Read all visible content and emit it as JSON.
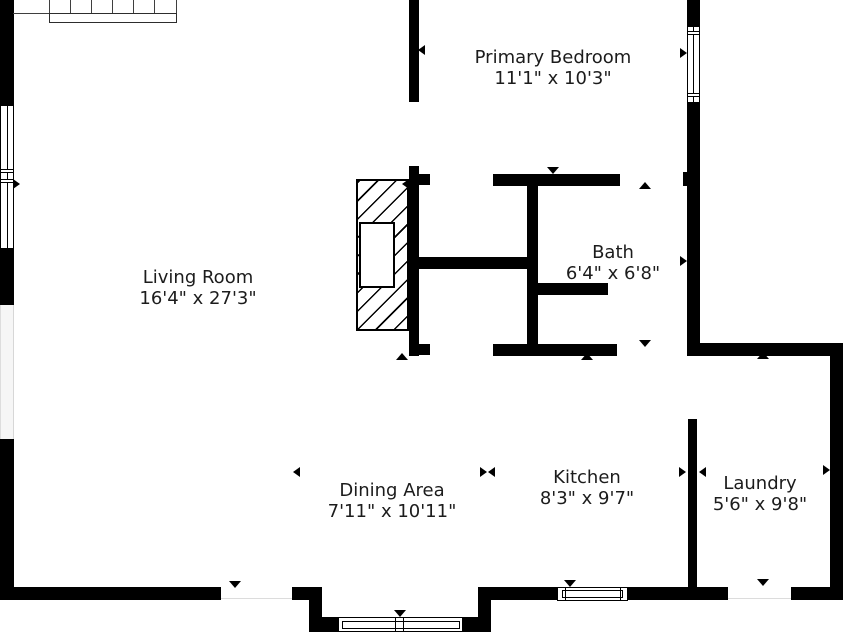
{
  "title": "First floor plan",
  "rooms": {
    "living_room": {
      "name": "Living Room",
      "dims": "16'4\" x 27'3\""
    },
    "primary_bedroom": {
      "name": "Primary Bedroom",
      "dims": "11'1\" x 10'3\""
    },
    "bath": {
      "name": "Bath",
      "dims": "6'4\" x 6'8\""
    },
    "dining_area": {
      "name": "Dining Area",
      "dims": "7'11\" x 10'11\""
    },
    "kitchen": {
      "name": "Kitchen",
      "dims": "8'3\" x 9'7\""
    },
    "laundry": {
      "name": "Laundry",
      "dims": "5'6\" x 9'8\""
    }
  },
  "features": {
    "stairs": "staircase",
    "fireplace": "fireplace",
    "door_marker": "triangle-arrow",
    "window_marker": "double-line-window"
  },
  "colors": {
    "wall": "#000000",
    "background": "#ffffff",
    "text": "#1c1c1c",
    "stairs_line": "#3f3f3f"
  }
}
